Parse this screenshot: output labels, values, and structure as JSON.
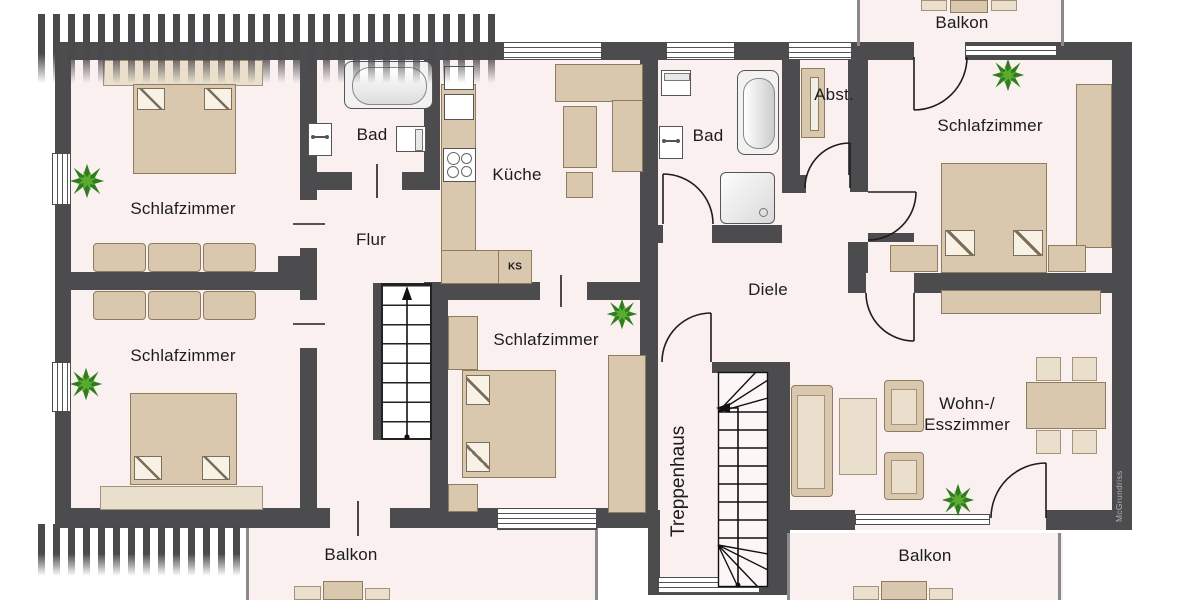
{
  "floorplan": {
    "type": "apartment-floor-plan",
    "watermark": "McGrundriss",
    "rooms": [
      {
        "id": "schlafzimmer-top-left",
        "label": "Schlafzimmer"
      },
      {
        "id": "schlafzimmer-bottom-left",
        "label": "Schlafzimmer"
      },
      {
        "id": "schlafzimmer-center",
        "label": "Schlafzimmer"
      },
      {
        "id": "schlafzimmer-right",
        "label": "Schlafzimmer"
      },
      {
        "id": "bad-left",
        "label": "Bad"
      },
      {
        "id": "bad-right",
        "label": "Bad"
      },
      {
        "id": "kueche",
        "label": "Küche"
      },
      {
        "id": "flur",
        "label": "Flur"
      },
      {
        "id": "diele",
        "label": "Diele"
      },
      {
        "id": "abstellraum",
        "label": "Abst."
      },
      {
        "id": "treppenhaus",
        "label": "Treppenhaus"
      },
      {
        "id": "wohn-esszimmer",
        "label_line1": "Wohn-/",
        "label_line2": "Esszimmer"
      },
      {
        "id": "balkon-top-right",
        "label": "Balkon"
      },
      {
        "id": "balkon-bottom-left",
        "label": "Balkon"
      },
      {
        "id": "balkon-bottom-right",
        "label": "Balkon"
      }
    ],
    "annotations": {
      "fridge": "KS"
    },
    "colors": {
      "wall": "#4c4c4e",
      "floor": "#faf0f0",
      "furniture": "#d9c8ad",
      "furniture_light": "#e9dfcc",
      "fixture_white": "#ffffff",
      "plant_dark": "#2f7d1e",
      "plant_light": "#5cab31",
      "watermark_text": "#b2b2b4"
    }
  }
}
